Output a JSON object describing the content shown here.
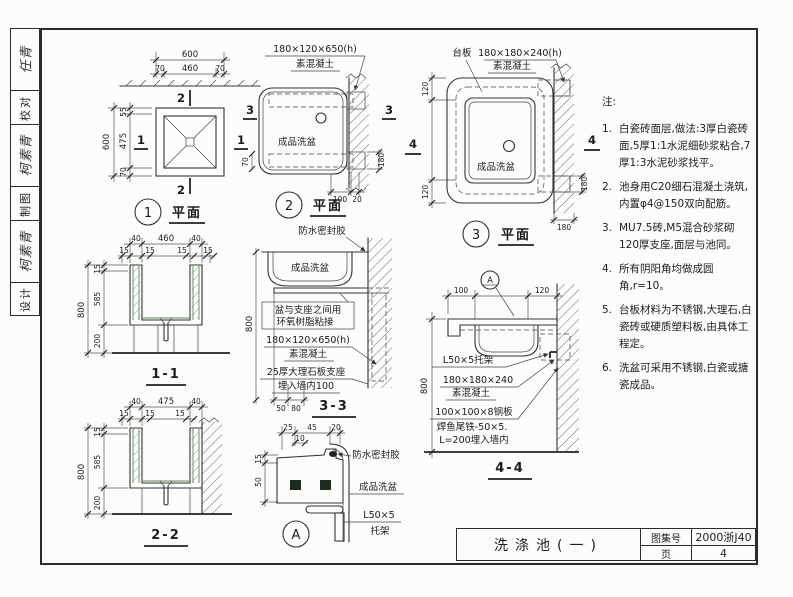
{
  "sidebar": {
    "rows": [
      {
        "text": "任青",
        "sig": true
      },
      {
        "text": "校对",
        "sig": false
      },
      {
        "text": "柯素青",
        "sig": true
      },
      {
        "text": "制图",
        "sig": false
      },
      {
        "text": "柯素青",
        "sig": true
      },
      {
        "text": "设计",
        "sig": false
      }
    ]
  },
  "titleblock": {
    "drawing_title": "洗涤池(一)",
    "atlas_label": "图集号",
    "atlas_number": "2000浙J40",
    "page_label": "页",
    "page_number": "4"
  },
  "notes": {
    "heading": "注:",
    "items": [
      {
        "num": "1.",
        "text": "白瓷砖面层,做法:3厚白瓷砖面,5厚1:1水泥细砂浆粘合,7厚1:3水泥砂浆找平。"
      },
      {
        "num": "2.",
        "text": "池身用C20细石混凝土浇筑,内置φ4@150双向配筋。"
      },
      {
        "num": "3.",
        "text": "MU7.5砖,M5混合砂浆砌120厚支座,面层与池同。"
      },
      {
        "num": "4.",
        "text": "所有阴阳角均做成圆角,r=10。"
      },
      {
        "num": "5.",
        "text": "台板材料为不锈钢,大理石,白瓷砖或硬质塑料板,由具体工程定。"
      },
      {
        "num": "6.",
        "text": "洗盆可采用不锈钢,白瓷或搪瓷成品。"
      }
    ]
  },
  "plan1": {
    "bubble": "1",
    "title": "平面",
    "dim_top_total": "600",
    "dim_top_left": "70",
    "dim_top_mid": "460",
    "dim_top_right": "70",
    "dim_left_total": "600",
    "dim_left_top": "55",
    "dim_left_mid": "475",
    "dim_left_bottom": "70",
    "marker_v": "2",
    "marker_h": "1"
  },
  "plan2": {
    "bubble": "2",
    "title": "平面",
    "concrete_size": "180×120×650(h)",
    "concrete": "素混凝土",
    "basin": "成品洗盆",
    "dim_70": "70",
    "dim_180": "180",
    "dim_100": "100",
    "dim_20": "20",
    "marker": "3"
  },
  "plan3": {
    "bubble": "3",
    "title": "平面",
    "taban": "台板",
    "concrete_size": "180×180×240(h)",
    "concrete": "素混凝土",
    "basin": "成品洗盆",
    "dim_left_top": "120",
    "dim_left_bottom": "120",
    "dim_right": "180",
    "dim_bottom": "180",
    "marker": "4"
  },
  "sec11": {
    "title": "1-1",
    "dim_40l": "40",
    "dim_460": "460",
    "dim_40r": "40",
    "dim_15a": "15",
    "dim_15b": "15",
    "dim_15c": "15",
    "dim_15d": "15",
    "dim_800": "800",
    "dim_15": "15",
    "dim_585": "585",
    "dim_200": "200"
  },
  "sec22": {
    "title": "2-2",
    "dim_40l": "40",
    "dim_475": "475",
    "dim_40r": "40",
    "dim_15a": "15",
    "dim_15b": "15",
    "dim_15c": "15",
    "dim_800": "800",
    "dim_15": "15",
    "dim_585": "585",
    "dim_200": "200"
  },
  "sec33": {
    "title": "3-3",
    "sealant": "防水密封胶",
    "basin": "成品洗盆",
    "epoxy1": "盆与支座之间用",
    "epoxy2": "环氧树脂粘接",
    "concrete_size": "180×120×650(h)",
    "concrete": "素混凝土",
    "marble1": "25厚大理石板支座",
    "marble2": "埋入墙内100",
    "dim_800": "800",
    "dim_50": "50",
    "dim_80": "80"
  },
  "sec44": {
    "title": "4-4",
    "bubble": "A",
    "dim_100": "100",
    "dim_120": "120",
    "dim_800": "800",
    "bracket": "L50×5托架",
    "concrete_size": "180×180×240",
    "concrete": "素混凝土",
    "steel": "100×100×8钢板",
    "fishtail": "焊鱼尾铁-50×5.",
    "embed": "L=200埋入墙内"
  },
  "detailA": {
    "bubble": "A",
    "sealant": "防水密封胶",
    "basin": "成品洗盆",
    "bracket1": "L50×5",
    "bracket2": "托架",
    "dim_25": "25",
    "dim_45": "45",
    "dim_20": "20",
    "dim_10": "10",
    "dim_15": "15",
    "dim_50": "50"
  }
}
